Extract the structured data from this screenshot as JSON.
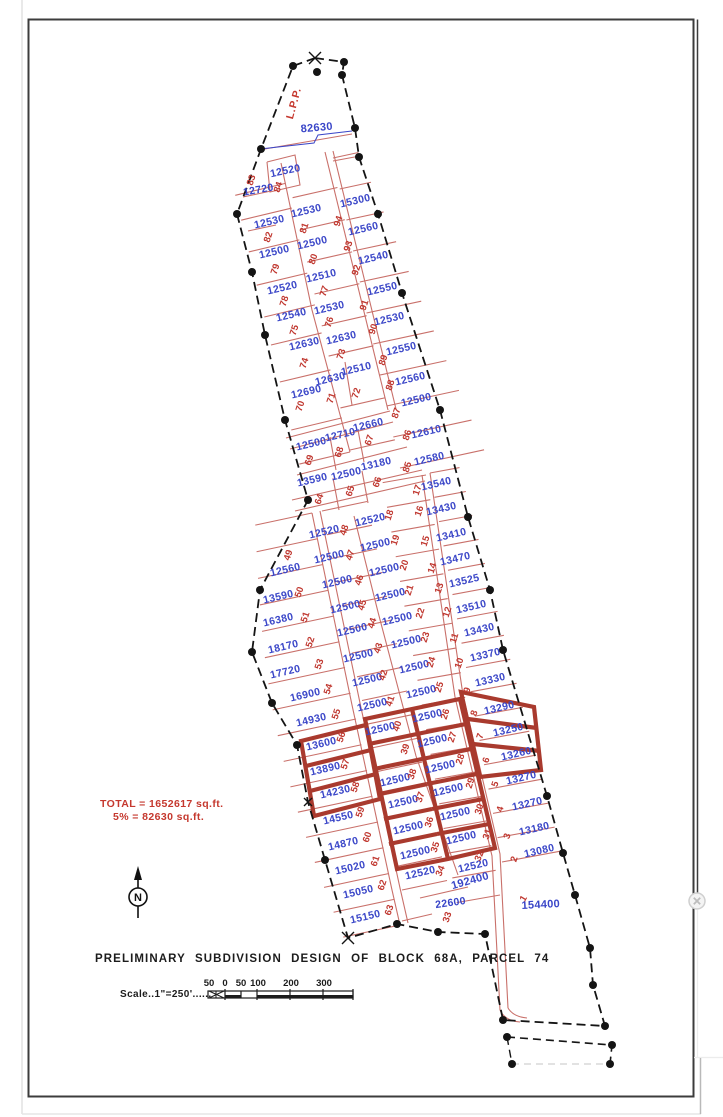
{
  "title_block": {
    "title": "PRELIMINARY SUBDIVISION DESIGN OF BLOCK 68A, PARCEL 74",
    "scale_label": "Scale..1\"=250'......",
    "north_letter": "N"
  },
  "annotations": {
    "lpp": "L.P.P.",
    "total_line1": "TOTAL = 1652617 sq.ft.",
    "total_line2": "5% = 82630 sq.ft."
  },
  "scale_bar": {
    "ticks": [
      "50",
      "0",
      "50",
      "100",
      "200",
      "300"
    ]
  },
  "colors": {
    "blue_text": "#3a46c8",
    "red_text": "#c03830",
    "red_line": "#c9706a",
    "thick_red": "#a93a2e",
    "boundary_black": "#141414"
  },
  "area_labels": [
    {
      "t": "82630",
      "x": 317,
      "y": 131,
      "r": -5,
      "s": 11
    },
    {
      "t": "12520",
      "x": 286,
      "y": 174,
      "r": -12
    },
    {
      "t": "12720",
      "x": 259,
      "y": 193,
      "r": -10
    },
    {
      "t": "12530",
      "x": 307,
      "y": 214,
      "r": -13
    },
    {
      "t": "15300",
      "x": 356,
      "y": 204,
      "r": -13
    },
    {
      "t": "12530",
      "x": 270,
      "y": 225,
      "r": -13
    },
    {
      "t": "12560",
      "x": 364,
      "y": 232,
      "r": -13
    },
    {
      "t": "12500",
      "x": 313,
      "y": 246,
      "r": -13
    },
    {
      "t": "12500",
      "x": 275,
      "y": 255,
      "r": -13
    },
    {
      "t": "12540",
      "x": 374,
      "y": 261,
      "r": -13
    },
    {
      "t": "12510",
      "x": 322,
      "y": 279,
      "r": -13
    },
    {
      "t": "12520",
      "x": 283,
      "y": 291,
      "r": -13
    },
    {
      "t": "12550",
      "x": 383,
      "y": 292,
      "r": -13
    },
    {
      "t": "12530",
      "x": 330,
      "y": 311,
      "r": -13
    },
    {
      "t": "12540",
      "x": 292,
      "y": 318,
      "r": -13
    },
    {
      "t": "12530",
      "x": 390,
      "y": 322,
      "r": -13
    },
    {
      "t": "12630",
      "x": 342,
      "y": 341,
      "r": -13
    },
    {
      "t": "12630",
      "x": 305,
      "y": 347,
      "r": -13
    },
    {
      "t": "12550",
      "x": 402,
      "y": 352,
      "r": -13
    },
    {
      "t": "12510",
      "x": 357,
      "y": 372,
      "r": -13
    },
    {
      "t": "12630",
      "x": 331,
      "y": 382,
      "r": -13
    },
    {
      "t": "12560",
      "x": 411,
      "y": 382,
      "r": -13
    },
    {
      "t": "12690",
      "x": 307,
      "y": 395,
      "r": -13
    },
    {
      "t": "12500",
      "x": 417,
      "y": 403,
      "r": -13
    },
    {
      "t": "12660",
      "x": 369,
      "y": 428,
      "r": -13
    },
    {
      "t": "12710",
      "x": 341,
      "y": 438,
      "r": -13
    },
    {
      "t": "12610",
      "x": 427,
      "y": 435,
      "r": -13
    },
    {
      "t": "12500",
      "x": 312,
      "y": 447,
      "r": -13
    },
    {
      "t": "12580",
      "x": 430,
      "y": 462,
      "r": -13
    },
    {
      "t": "13180",
      "x": 377,
      "y": 467,
      "r": -13
    },
    {
      "t": "12500",
      "x": 347,
      "y": 477,
      "r": -13
    },
    {
      "t": "13590",
      "x": 313,
      "y": 483,
      "r": -13
    },
    {
      "t": "13540",
      "x": 437,
      "y": 487,
      "r": -13
    },
    {
      "t": "13430",
      "x": 442,
      "y": 512,
      "r": -13
    },
    {
      "t": "12520",
      "x": 371,
      "y": 523,
      "r": -13
    },
    {
      "t": "12520",
      "x": 325,
      "y": 535,
      "r": -13
    },
    {
      "t": "13410",
      "x": 452,
      "y": 538,
      "r": -13
    },
    {
      "t": "12500",
      "x": 376,
      "y": 548,
      "r": -13
    },
    {
      "t": "12500",
      "x": 330,
      "y": 560,
      "r": -13
    },
    {
      "t": "13470",
      "x": 456,
      "y": 562,
      "r": -13
    },
    {
      "t": "12500",
      "x": 385,
      "y": 573,
      "r": -13
    },
    {
      "t": "12560",
      "x": 286,
      "y": 573,
      "r": -13
    },
    {
      "t": "13525",
      "x": 465,
      "y": 584,
      "r": -13
    },
    {
      "t": "12500",
      "x": 338,
      "y": 585,
      "r": -13
    },
    {
      "t": "12500",
      "x": 391,
      "y": 598,
      "r": -13
    },
    {
      "t": "13590",
      "x": 279,
      "y": 600,
      "r": -13
    },
    {
      "t": "13510",
      "x": 472,
      "y": 610,
      "r": -13
    },
    {
      "t": "12500",
      "x": 346,
      "y": 610,
      "r": -13
    },
    {
      "t": "12500",
      "x": 398,
      "y": 622,
      "r": -13
    },
    {
      "t": "16380",
      "x": 279,
      "y": 623,
      "r": -13
    },
    {
      "t": "13430",
      "x": 480,
      "y": 633,
      "r": -13
    },
    {
      "t": "12500",
      "x": 353,
      "y": 633,
      "r": -13
    },
    {
      "t": "12500",
      "x": 407,
      "y": 645,
      "r": -13
    },
    {
      "t": "18170",
      "x": 284,
      "y": 650,
      "r": -13
    },
    {
      "t": "13370",
      "x": 486,
      "y": 658,
      "r": -13
    },
    {
      "t": "12500",
      "x": 359,
      "y": 659,
      "r": -13
    },
    {
      "t": "12500",
      "x": 415,
      "y": 670,
      "r": -13
    },
    {
      "t": "17720",
      "x": 286,
      "y": 675,
      "r": -13
    },
    {
      "t": "13330",
      "x": 491,
      "y": 683,
      "r": -13
    },
    {
      "t": "12500",
      "x": 368,
      "y": 683,
      "r": -13
    },
    {
      "t": "12500",
      "x": 422,
      "y": 695,
      "r": -13
    },
    {
      "t": "16900",
      "x": 306,
      "y": 698,
      "r": -13
    },
    {
      "t": "12500",
      "x": 373,
      "y": 708,
      "r": -13
    },
    {
      "t": "13290",
      "x": 500,
      "y": 711,
      "r": -13
    },
    {
      "t": "12500",
      "x": 428,
      "y": 719,
      "r": -13
    },
    {
      "t": "14930",
      "x": 312,
      "y": 723,
      "r": -13
    },
    {
      "t": "13250",
      "x": 509,
      "y": 733,
      "r": -13
    },
    {
      "t": "12500",
      "x": 381,
      "y": 732,
      "r": -13
    },
    {
      "t": "12500",
      "x": 433,
      "y": 744,
      "r": -13
    },
    {
      "t": "13600",
      "x": 322,
      "y": 747,
      "r": -13
    },
    {
      "t": "13260",
      "x": 517,
      "y": 757,
      "r": -13
    },
    {
      "t": "12500",
      "x": 441,
      "y": 770,
      "r": -13
    },
    {
      "t": "13890",
      "x": 326,
      "y": 772,
      "r": -13
    },
    {
      "t": "13270",
      "x": 522,
      "y": 781,
      "r": -13
    },
    {
      "t": "12500",
      "x": 396,
      "y": 783,
      "r": -13
    },
    {
      "t": "12500",
      "x": 449,
      "y": 793,
      "r": -13
    },
    {
      "t": "14230",
      "x": 336,
      "y": 795,
      "r": -13
    },
    {
      "t": "12500",
      "x": 404,
      "y": 805,
      "r": -13
    },
    {
      "t": "13270",
      "x": 528,
      "y": 807,
      "r": -13
    },
    {
      "t": "12500",
      "x": 456,
      "y": 817,
      "r": -13
    },
    {
      "t": "14550",
      "x": 339,
      "y": 821,
      "r": -13
    },
    {
      "t": "12500",
      "x": 409,
      "y": 831,
      "r": -13
    },
    {
      "t": "13180",
      "x": 535,
      "y": 832,
      "r": -13
    },
    {
      "t": "12500",
      "x": 462,
      "y": 841,
      "r": -13
    },
    {
      "t": "14870",
      "x": 344,
      "y": 847,
      "r": -13
    },
    {
      "t": "13080",
      "x": 540,
      "y": 854,
      "r": -13
    },
    {
      "t": "12500",
      "x": 416,
      "y": 856,
      "r": -13
    },
    {
      "t": "12520",
      "x": 474,
      "y": 869,
      "r": -13
    },
    {
      "t": "15020",
      "x": 351,
      "y": 871,
      "r": -13
    },
    {
      "t": "12520",
      "x": 421,
      "y": 876,
      "r": -13
    },
    {
      "t": "15050",
      "x": 359,
      "y": 895,
      "r": -13
    },
    {
      "t": "192400",
      "x": 471,
      "y": 884,
      "r": -16,
      "s": 11
    },
    {
      "t": "22600",
      "x": 451,
      "y": 906,
      "r": -8
    },
    {
      "t": "154400",
      "x": 541,
      "y": 908,
      "r": -3,
      "s": 11
    },
    {
      "t": "15150",
      "x": 366,
      "y": 920,
      "r": -13
    }
  ],
  "lot_numbers": [
    {
      "t": "83",
      "x": 254,
      "y": 181
    },
    {
      "t": "84",
      "x": 281,
      "y": 188
    },
    {
      "t": "82",
      "x": 271,
      "y": 238
    },
    {
      "t": "81",
      "x": 307,
      "y": 229
    },
    {
      "t": "94",
      "x": 341,
      "y": 222
    },
    {
      "t": "93",
      "x": 351,
      "y": 247
    },
    {
      "t": "80",
      "x": 316,
      "y": 260
    },
    {
      "t": "79",
      "x": 278,
      "y": 270
    },
    {
      "t": "92",
      "x": 359,
      "y": 271
    },
    {
      "t": "77",
      "x": 327,
      "y": 292
    },
    {
      "t": "78",
      "x": 287,
      "y": 302
    },
    {
      "t": "91",
      "x": 367,
      "y": 306
    },
    {
      "t": "76",
      "x": 332,
      "y": 323
    },
    {
      "t": "75",
      "x": 297,
      "y": 331
    },
    {
      "t": "90",
      "x": 376,
      "y": 330
    },
    {
      "t": "73",
      "x": 344,
      "y": 355
    },
    {
      "t": "74",
      "x": 307,
      "y": 364
    },
    {
      "t": "89",
      "x": 386,
      "y": 361
    },
    {
      "t": "72",
      "x": 359,
      "y": 394
    },
    {
      "t": "71",
      "x": 334,
      "y": 399
    },
    {
      "t": "88",
      "x": 393,
      "y": 386
    },
    {
      "t": "70",
      "x": 303,
      "y": 407
    },
    {
      "t": "87",
      "x": 399,
      "y": 414
    },
    {
      "t": "67",
      "x": 372,
      "y": 441
    },
    {
      "t": "68",
      "x": 342,
      "y": 453
    },
    {
      "t": "86",
      "x": 410,
      "y": 436
    },
    {
      "t": "69",
      "x": 312,
      "y": 461
    },
    {
      "t": "66",
      "x": 380,
      "y": 483
    },
    {
      "t": "65",
      "x": 353,
      "y": 492
    },
    {
      "t": "64",
      "x": 322,
      "y": 500
    },
    {
      "t": "85",
      "x": 410,
      "y": 468
    },
    {
      "t": "17",
      "x": 420,
      "y": 491
    },
    {
      "t": "18",
      "x": 392,
      "y": 516
    },
    {
      "t": "16",
      "x": 422,
      "y": 512
    },
    {
      "t": "48",
      "x": 347,
      "y": 531
    },
    {
      "t": "19",
      "x": 398,
      "y": 541
    },
    {
      "t": "15",
      "x": 428,
      "y": 542
    },
    {
      "t": "47",
      "x": 353,
      "y": 556
    },
    {
      "t": "20",
      "x": 407,
      "y": 566
    },
    {
      "t": "14",
      "x": 435,
      "y": 569
    },
    {
      "t": "49",
      "x": 291,
      "y": 556
    },
    {
      "t": "46",
      "x": 362,
      "y": 581
    },
    {
      "t": "13",
      "x": 442,
      "y": 589
    },
    {
      "t": "50",
      "x": 302,
      "y": 593
    },
    {
      "t": "21",
      "x": 412,
      "y": 591
    },
    {
      "t": "45",
      "x": 365,
      "y": 606
    },
    {
      "t": "12",
      "x": 450,
      "y": 613
    },
    {
      "t": "51",
      "x": 308,
      "y": 618
    },
    {
      "t": "44",
      "x": 375,
      "y": 624
    },
    {
      "t": "22",
      "x": 423,
      "y": 614
    },
    {
      "t": "11",
      "x": 457,
      "y": 639
    },
    {
      "t": "52",
      "x": 313,
      "y": 643
    },
    {
      "t": "43",
      "x": 381,
      "y": 649
    },
    {
      "t": "23",
      "x": 428,
      "y": 638
    },
    {
      "t": "10",
      "x": 462,
      "y": 664
    },
    {
      "t": "53",
      "x": 322,
      "y": 665
    },
    {
      "t": "42",
      "x": 386,
      "y": 676
    },
    {
      "t": "24",
      "x": 434,
      "y": 663
    },
    {
      "t": "9",
      "x": 470,
      "y": 691
    },
    {
      "t": "54",
      "x": 331,
      "y": 690
    },
    {
      "t": "41",
      "x": 393,
      "y": 702
    },
    {
      "t": "25",
      "x": 442,
      "y": 688
    },
    {
      "t": "8",
      "x": 477,
      "y": 714
    },
    {
      "t": "55",
      "x": 339,
      "y": 715
    },
    {
      "t": "40",
      "x": 400,
      "y": 727
    },
    {
      "t": "26",
      "x": 448,
      "y": 715
    },
    {
      "t": "7",
      "x": 483,
      "y": 737
    },
    {
      "t": "56",
      "x": 344,
      "y": 738
    },
    {
      "t": "39",
      "x": 408,
      "y": 750
    },
    {
      "t": "27",
      "x": 455,
      "y": 738
    },
    {
      "t": "6",
      "x": 489,
      "y": 761
    },
    {
      "t": "57",
      "x": 348,
      "y": 765
    },
    {
      "t": "38",
      "x": 415,
      "y": 775
    },
    {
      "t": "28",
      "x": 463,
      "y": 760
    },
    {
      "t": "5",
      "x": 498,
      "y": 785
    },
    {
      "t": "58",
      "x": 358,
      "y": 788
    },
    {
      "t": "37",
      "x": 423,
      "y": 798
    },
    {
      "t": "29",
      "x": 473,
      "y": 784
    },
    {
      "t": "4",
      "x": 503,
      "y": 810
    },
    {
      "t": "59",
      "x": 363,
      "y": 813
    },
    {
      "t": "36",
      "x": 432,
      "y": 823
    },
    {
      "t": "30",
      "x": 482,
      "y": 810
    },
    {
      "t": "3",
      "x": 510,
      "y": 837
    },
    {
      "t": "60",
      "x": 370,
      "y": 838
    },
    {
      "t": "35",
      "x": 438,
      "y": 848
    },
    {
      "t": "31",
      "x": 490,
      "y": 835
    },
    {
      "t": "2",
      "x": 517,
      "y": 860
    },
    {
      "t": "61",
      "x": 378,
      "y": 862
    },
    {
      "t": "34",
      "x": 443,
      "y": 872,
      "r": -68
    },
    {
      "t": "32",
      "x": 482,
      "y": 857,
      "r": -68
    },
    {
      "t": "1",
      "x": 526,
      "y": 900,
      "r": -60
    },
    {
      "t": "62",
      "x": 385,
      "y": 886
    },
    {
      "t": "63",
      "x": 392,
      "y": 911
    },
    {
      "t": "33",
      "x": 450,
      "y": 918
    }
  ]
}
